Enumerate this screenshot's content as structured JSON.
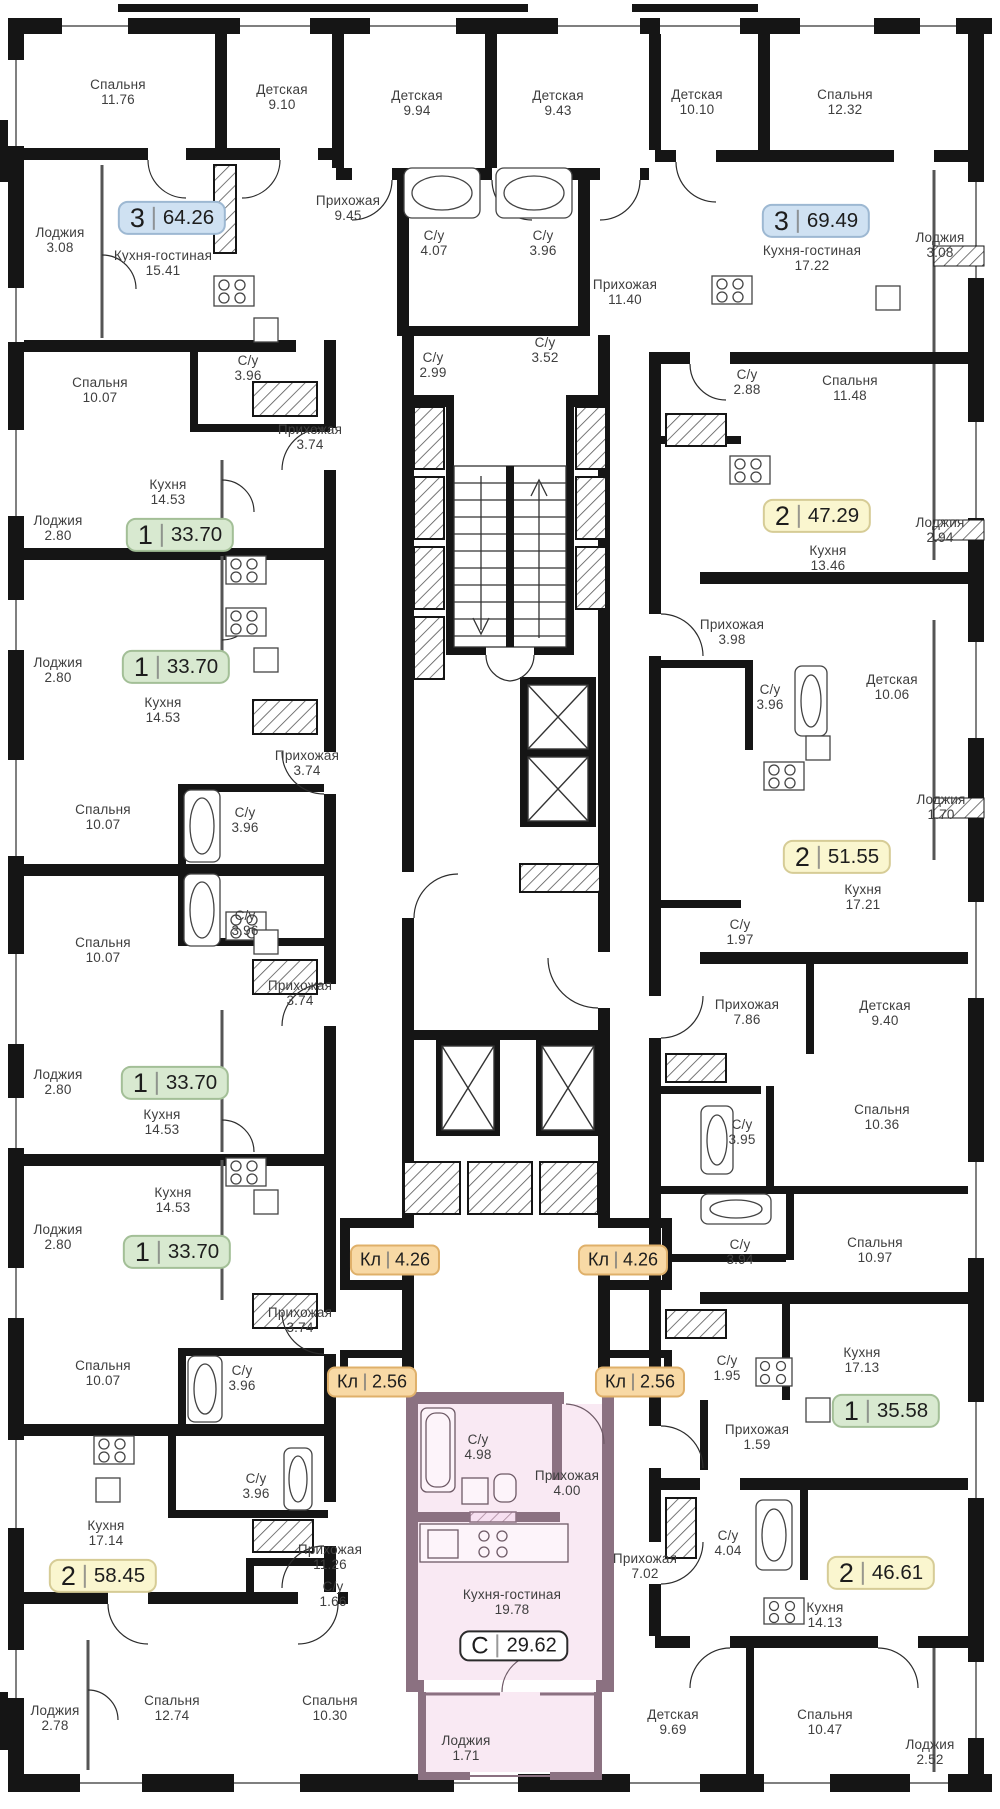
{
  "plan": {
    "badge_colors": {
      "blue": {
        "bg": "#cfe1f2",
        "border": "#9db8d2"
      },
      "green": {
        "bg": "#d8e9d0",
        "border": "#a3bf97"
      },
      "yellow": {
        "bg": "#faf6cf",
        "border": "#d6cc96"
      },
      "orange": {
        "bg": "#f8d9a5",
        "border": "#dfb06a"
      },
      "studio": {
        "bg": "#ffffff",
        "border": "#2b2b2b"
      }
    },
    "highlight_color": "#f9e9f3",
    "highlight_wall_color": "#8b7181",
    "rooms": [
      {
        "name": "Спальня",
        "area": "11.76",
        "x": 118,
        "y": 92
      },
      {
        "name": "Детская",
        "area": "9.10",
        "x": 282,
        "y": 97
      },
      {
        "name": "Лоджия",
        "area": "3.08",
        "x": 60,
        "y": 240
      },
      {
        "name": "Кухня-гостиная",
        "area": "15.41",
        "x": 163,
        "y": 263
      },
      {
        "name": "Спальня",
        "area": "10.07",
        "x": 100,
        "y": 390
      },
      {
        "name": "С/у",
        "area": "3.96",
        "x": 248,
        "y": 368
      },
      {
        "name": "Прихожая",
        "area": "3.74",
        "x": 310,
        "y": 437
      },
      {
        "name": "Кухня",
        "area": "14.53",
        "x": 168,
        "y": 492
      },
      {
        "name": "Лоджия",
        "area": "2.80",
        "x": 58,
        "y": 528
      },
      {
        "name": "Лоджия",
        "area": "2.80",
        "x": 58,
        "y": 670
      },
      {
        "name": "Кухня",
        "area": "14.53",
        "x": 163,
        "y": 710
      },
      {
        "name": "Прихожая",
        "area": "3.74",
        "x": 307,
        "y": 763
      },
      {
        "name": "Спальня",
        "area": "10.07",
        "x": 103,
        "y": 817
      },
      {
        "name": "С/у",
        "area": "3.96",
        "x": 245,
        "y": 820
      },
      {
        "name": "С/у",
        "area": "3.96",
        "x": 245,
        "y": 923
      },
      {
        "name": "Спальня",
        "area": "10.07",
        "x": 103,
        "y": 950
      },
      {
        "name": "Прихожая",
        "area": "3.74",
        "x": 300,
        "y": 993
      },
      {
        "name": "Лоджия",
        "area": "2.80",
        "x": 58,
        "y": 1082
      },
      {
        "name": "Кухня",
        "area": "14.53",
        "x": 162,
        "y": 1122
      },
      {
        "name": "Кухня",
        "area": "14.53",
        "x": 173,
        "y": 1200
      },
      {
        "name": "Лоджия",
        "area": "2.80",
        "x": 58,
        "y": 1237
      },
      {
        "name": "Прихожая",
        "area": "3.74",
        "x": 300,
        "y": 1320
      },
      {
        "name": "Спальня",
        "area": "10.07",
        "x": 103,
        "y": 1373
      },
      {
        "name": "С/у",
        "area": "3.96",
        "x": 242,
        "y": 1378
      },
      {
        "name": "С/у",
        "area": "3.96",
        "x": 256,
        "y": 1486
      },
      {
        "name": "Кухня",
        "area": "17.14",
        "x": 106,
        "y": 1533
      },
      {
        "name": "Прихожая",
        "area": "11.26",
        "x": 330,
        "y": 1557
      },
      {
        "name": "С/у",
        "area": "1.66",
        "x": 333,
        "y": 1594
      },
      {
        "name": "Лоджия",
        "area": "2.78",
        "x": 55,
        "y": 1718
      },
      {
        "name": "Спальня",
        "area": "12.74",
        "x": 172,
        "y": 1708
      },
      {
        "name": "Спальня",
        "area": "10.30",
        "x": 330,
        "y": 1708
      },
      {
        "name": "Детская",
        "area": "9.94",
        "x": 417,
        "y": 103
      },
      {
        "name": "Детская",
        "area": "9.43",
        "x": 558,
        "y": 103
      },
      {
        "name": "Прихожая",
        "area": "9.45",
        "x": 348,
        "y": 208
      },
      {
        "name": "С/у",
        "area": "4.07",
        "x": 434,
        "y": 243
      },
      {
        "name": "С/у",
        "area": "3.96",
        "x": 543,
        "y": 243
      },
      {
        "name": "С/у",
        "area": "2.99",
        "x": 433,
        "y": 365
      },
      {
        "name": "С/у",
        "area": "3.52",
        "x": 545,
        "y": 350
      },
      {
        "name": "Прихожая",
        "area": "11.40",
        "x": 625,
        "y": 292
      },
      {
        "name": "С/у",
        "area": "4.98",
        "x": 478,
        "y": 1447
      },
      {
        "name": "Прихожая",
        "area": "4.00",
        "x": 567,
        "y": 1483
      },
      {
        "name": "Кухня-гостиная",
        "area": "19.78",
        "x": 512,
        "y": 1602
      },
      {
        "name": "Лоджия",
        "area": "1.71",
        "x": 466,
        "y": 1748
      },
      {
        "name": "Прихожая",
        "area": "7.02",
        "x": 645,
        "y": 1566
      },
      {
        "name": "Детская",
        "area": "10.10",
        "x": 697,
        "y": 102
      },
      {
        "name": "Спальня",
        "area": "12.32",
        "x": 845,
        "y": 102
      },
      {
        "name": "Лоджия",
        "area": "3.08",
        "x": 940,
        "y": 245
      },
      {
        "name": "Кухня-гостиная",
        "area": "17.22",
        "x": 812,
        "y": 258
      },
      {
        "name": "С/у",
        "area": "2.88",
        "x": 747,
        "y": 382
      },
      {
        "name": "Спальня",
        "area": "11.48",
        "x": 850,
        "y": 388
      },
      {
        "name": "Кухня",
        "area": "13.46",
        "x": 828,
        "y": 558
      },
      {
        "name": "Лоджия",
        "area": "2.94",
        "x": 940,
        "y": 530
      },
      {
        "name": "Прихожая",
        "area": "3.98",
        "x": 732,
        "y": 632
      },
      {
        "name": "С/у",
        "area": "3.96",
        "x": 770,
        "y": 697
      },
      {
        "name": "Детская",
        "area": "10.06",
        "x": 892,
        "y": 687
      },
      {
        "name": "Лоджия",
        "area": "1.70",
        "x": 941,
        "y": 807
      },
      {
        "name": "Кухня",
        "area": "17.21",
        "x": 863,
        "y": 897
      },
      {
        "name": "С/у",
        "area": "1.97",
        "x": 740,
        "y": 932
      },
      {
        "name": "Прихожая",
        "area": "7.86",
        "x": 747,
        "y": 1012
      },
      {
        "name": "Детская",
        "area": "9.40",
        "x": 885,
        "y": 1013
      },
      {
        "name": "С/у",
        "area": "3.95",
        "x": 742,
        "y": 1132
      },
      {
        "name": "Спальня",
        "area": "10.36",
        "x": 882,
        "y": 1117
      },
      {
        "name": "С/у",
        "area": "3.94",
        "x": 740,
        "y": 1252
      },
      {
        "name": "Спальня",
        "area": "10.97",
        "x": 875,
        "y": 1250
      },
      {
        "name": "С/у",
        "area": "1.95",
        "x": 727,
        "y": 1368
      },
      {
        "name": "Кухня",
        "area": "17.13",
        "x": 862,
        "y": 1360
      },
      {
        "name": "Прихожая",
        "area": "1.59",
        "x": 757,
        "y": 1437
      },
      {
        "name": "С/у",
        "area": "4.04",
        "x": 728,
        "y": 1543
      },
      {
        "name": "Кухня",
        "area": "14.13",
        "x": 825,
        "y": 1615
      },
      {
        "name": "Детская",
        "area": "9.69",
        "x": 673,
        "y": 1722
      },
      {
        "name": "Спальня",
        "area": "10.47",
        "x": 825,
        "y": 1722
      },
      {
        "name": "Лоджия",
        "area": "2.52",
        "x": 930,
        "y": 1752
      }
    ],
    "units": [
      {
        "num": "3",
        "area": "64.26",
        "kind": "blue",
        "x": 172,
        "y": 218
      },
      {
        "num": "3",
        "area": "69.49",
        "kind": "blue",
        "x": 816,
        "y": 221
      },
      {
        "num": "1",
        "area": "33.70",
        "kind": "green",
        "x": 180,
        "y": 535
      },
      {
        "num": "1",
        "area": "33.70",
        "kind": "green",
        "x": 176,
        "y": 667
      },
      {
        "num": "2",
        "area": "47.29",
        "kind": "yellow",
        "x": 817,
        "y": 516
      },
      {
        "num": "2",
        "area": "51.55",
        "kind": "yellow",
        "x": 837,
        "y": 857
      },
      {
        "num": "1",
        "area": "33.70",
        "kind": "green",
        "x": 175,
        "y": 1083
      },
      {
        "num": "1",
        "area": "33.70",
        "kind": "green",
        "x": 177,
        "y": 1252
      },
      {
        "num": "Кл",
        "area": "4.26",
        "kind": "orange",
        "x": 395,
        "y": 1260
      },
      {
        "num": "Кл",
        "area": "4.26",
        "kind": "orange",
        "x": 623,
        "y": 1260
      },
      {
        "num": "Кл",
        "area": "2.56",
        "kind": "orange",
        "x": 372,
        "y": 1382
      },
      {
        "num": "Кл",
        "area": "2.56",
        "kind": "orange",
        "x": 640,
        "y": 1382
      },
      {
        "num": "1",
        "area": "35.58",
        "kind": "green",
        "x": 886,
        "y": 1411
      },
      {
        "num": "2",
        "area": "58.45",
        "kind": "yellow",
        "x": 103,
        "y": 1576
      },
      {
        "num": "2",
        "area": "46.61",
        "kind": "yellow",
        "x": 881,
        "y": 1573
      },
      {
        "num": "С",
        "area": "29.62",
        "kind": "studio",
        "x": 514,
        "y": 1646
      }
    ]
  }
}
